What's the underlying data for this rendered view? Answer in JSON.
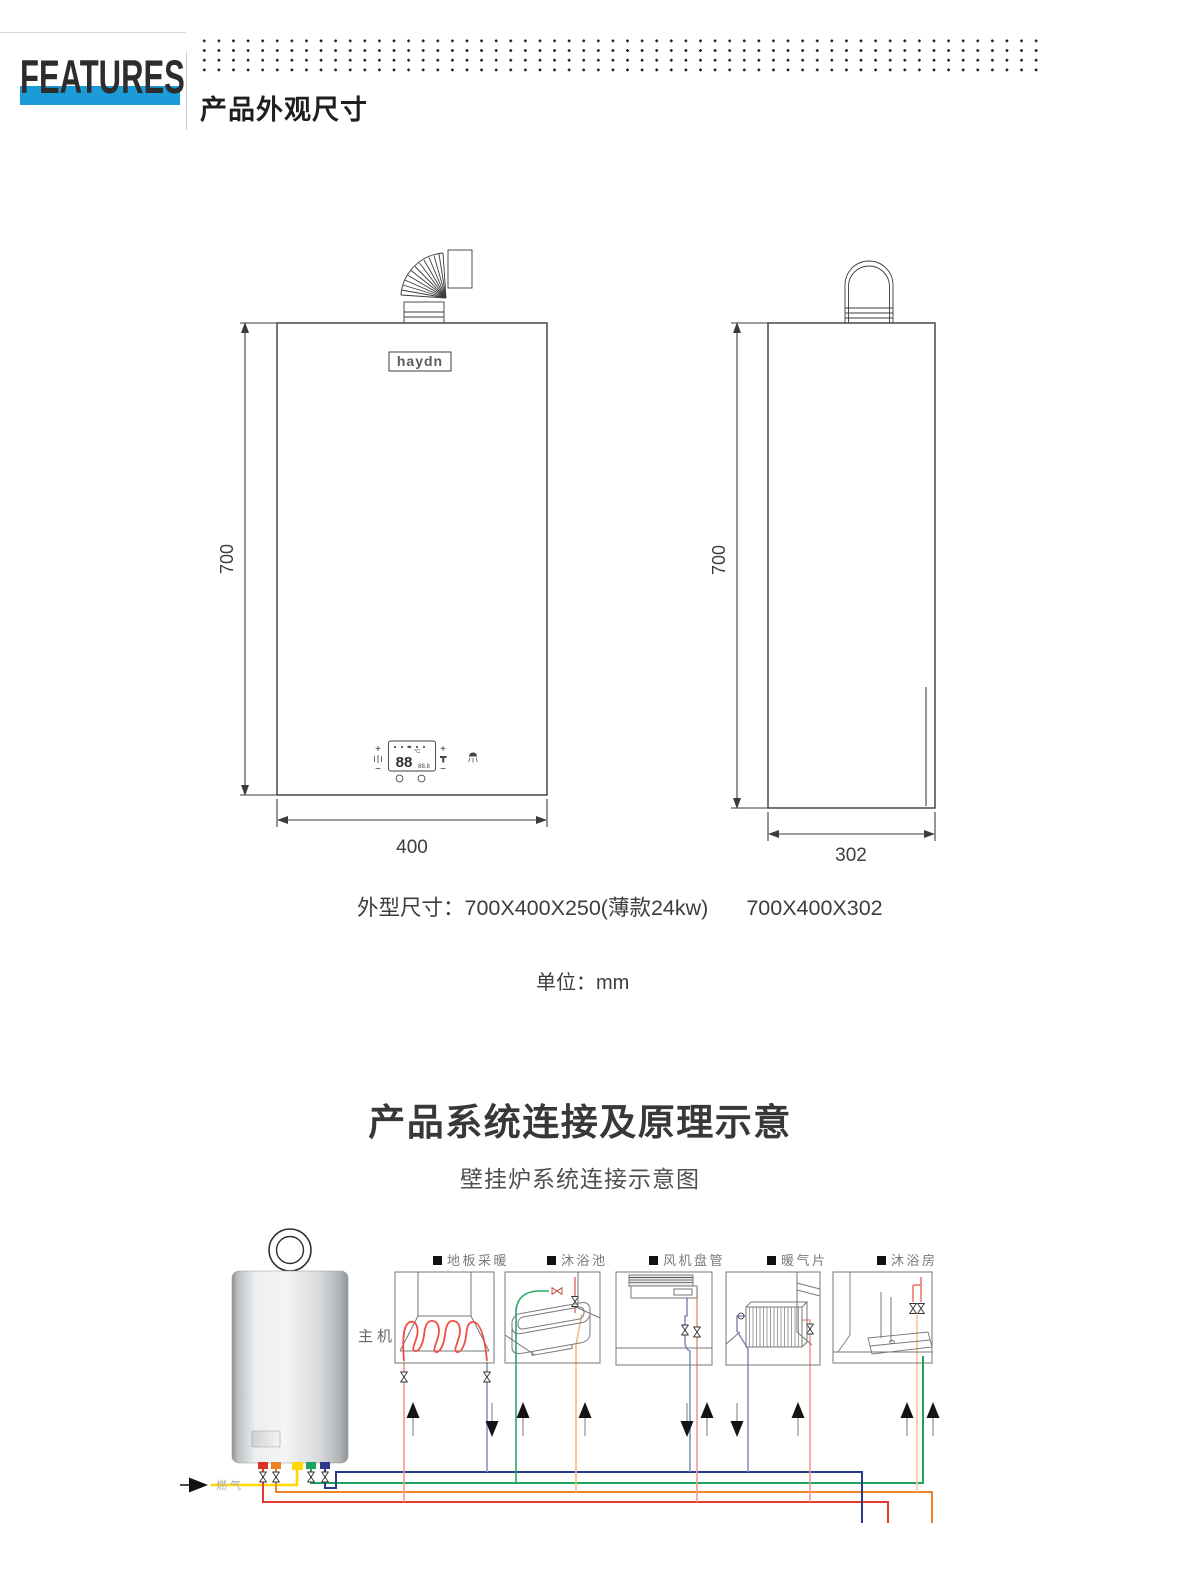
{
  "header": {
    "brand": "FEATURES",
    "section_title": "产品外观尺寸",
    "accent_color": "#1b9cd8"
  },
  "drawings": {
    "front": {
      "logo": "haydn",
      "height": "700",
      "width": "400",
      "panel": {
        "digits": "88",
        "unit": "°C",
        "sub_digits": "88.8",
        "plus": "+",
        "minus": "−"
      }
    },
    "side": {
      "height": "700",
      "depth": "302"
    }
  },
  "notes": {
    "size_label": "外型尺寸：",
    "size_slim": "700X400X250(薄款24kw)",
    "size_standard": "700X400X302",
    "unit_note": "单位：mm"
  },
  "system": {
    "title": "产品系统连接及原理示意",
    "subtitle": "壁挂炉系统连接示意图",
    "boiler_label": "主机",
    "gas_label": "燃气",
    "appliances": [
      {
        "label": "地板采暖"
      },
      {
        "label": "沐浴池"
      },
      {
        "label": "风机盘管"
      },
      {
        "label": "暖气片"
      },
      {
        "label": "沐浴房"
      }
    ],
    "pipe_colors": {
      "heating_supply_red": "#e23b2e",
      "heating_return_navy": "#2d3a8c",
      "gas_yellow": "#ffd900",
      "hot_water_orange": "#f08428",
      "cold_water_green": "#1ea25f"
    }
  }
}
